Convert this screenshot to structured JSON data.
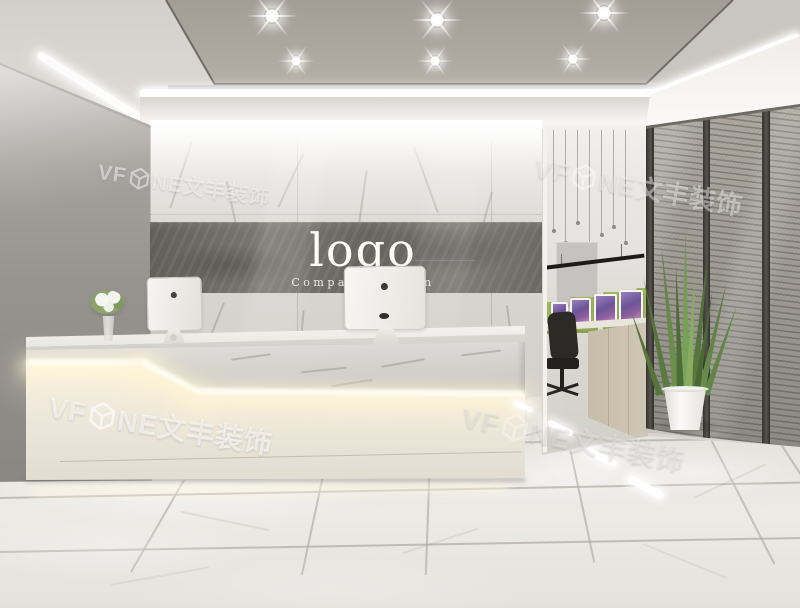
{
  "scene": {
    "description": "office reception interior rendering",
    "logo_wall": {
      "logo": "logo",
      "slogan": "Company Slogan"
    },
    "watermark": {
      "prefix": "VF",
      "suffix": "NE文丰装饰",
      "full_text": "VFONE文丰装饰",
      "instances": 4
    },
    "colors": {
      "ceiling_panel": "#a8a39b",
      "led_white": "#ffffff",
      "left_wall": "#99968f",
      "marble_wall": "#dcd9d4",
      "logo_band": "#6b6762",
      "desk_white": "#efe9df",
      "desk_glow": "#fff4d6",
      "floor": "#e8e5e0",
      "glass_partition": "#9c9890",
      "plant_green": "#6d8f4c",
      "office_divider_green": "#a2bc60",
      "screen_purple": "#7c5fa0",
      "pendant_black": "#1e1d1b"
    }
  }
}
